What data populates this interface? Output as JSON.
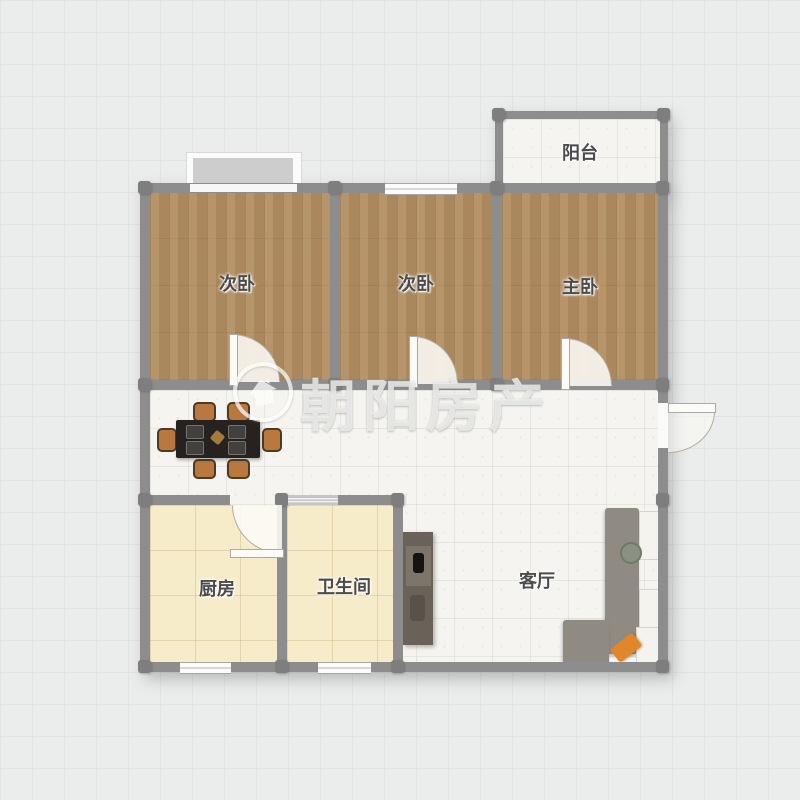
{
  "floorplan": {
    "rooms": [
      {
        "id": "bedroom-left",
        "label": "次卧"
      },
      {
        "id": "bedroom-middle",
        "label": "次卧"
      },
      {
        "id": "bedroom-master",
        "label": "主卧"
      },
      {
        "id": "balcony",
        "label": "阳台"
      },
      {
        "id": "kitchen",
        "label": "厨房"
      },
      {
        "id": "bathroom",
        "label": "卫生间"
      },
      {
        "id": "living-room",
        "label": "客厅"
      }
    ],
    "watermark": {
      "brand": "朝阳房产",
      "logo": "house-in-circle-icon"
    },
    "furniture": [
      "dining-table-six-chairs",
      "l-shaped-sofa",
      "tv-cabinet",
      "potted-plant",
      "orange-cushion"
    ],
    "colors": {
      "wall": "#8d8d8d",
      "wood_floor": "#b38e61",
      "tile_floor": "#f5f4f0",
      "cream_floor": "#f6ecca",
      "table": "#262220",
      "chair": "#b9783e",
      "sofa": "#8f8b83",
      "accent_orange": "#e0862b"
    }
  }
}
